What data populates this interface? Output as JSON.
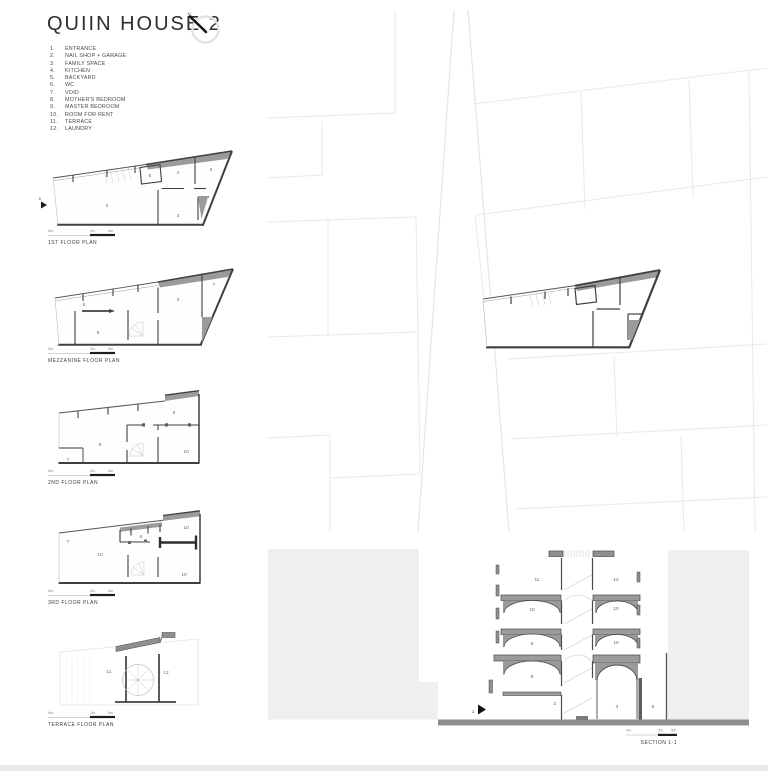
{
  "title": "QUIIN HOUSE 2",
  "north_label": "N.",
  "legend": [
    {
      "num": "1.",
      "label": "ENTRANCE"
    },
    {
      "num": "2.",
      "label": "NAIL SHOP + GARAGE"
    },
    {
      "num": "3.",
      "label": "FAMILY SPACE"
    },
    {
      "num": "4.",
      "label": "KITCHEN"
    },
    {
      "num": "5.",
      "label": "BACKYARD"
    },
    {
      "num": "6.",
      "label": "WC"
    },
    {
      "num": "7.",
      "label": "VOID"
    },
    {
      "num": "8.",
      "label": "MOTHER'S BEDROOM"
    },
    {
      "num": "9.",
      "label": "MASTER BEDROOM"
    },
    {
      "num": "10.",
      "label": "ROOM FOR RENT"
    },
    {
      "num": "11.",
      "label": "TERRACE"
    },
    {
      "num": "12.",
      "label": "LAUNDRY"
    }
  ],
  "scale": {
    "zero": "0m",
    "mid": "2m",
    "end": "5m"
  },
  "plans": [
    {
      "label": "1ST FLOOR PLAN",
      "marker": "1",
      "rooms": [
        "2",
        "6",
        "4",
        "5",
        "3"
      ]
    },
    {
      "label": "MEZZANINE FLOOR PLAN",
      "rooms": [
        "6",
        "8",
        "3",
        "7"
      ]
    },
    {
      "label": "2ND FLOOR PLAN",
      "rooms": [
        "7",
        "9",
        "6",
        "10"
      ]
    },
    {
      "label": "3RD FLOOR PLAN",
      "rooms": [
        "7",
        "10",
        "6",
        "10",
        "10"
      ]
    },
    {
      "label": "TERRACE FLOOR PLAN",
      "rooms": [
        "11",
        "12"
      ]
    }
  ],
  "section": {
    "label": "SECTION 1-1",
    "marker": "1",
    "rooms": [
      "11",
      "12",
      "10",
      "10",
      "9",
      "10",
      "8",
      "2",
      "3",
      "5"
    ]
  },
  "colors": {
    "wall": "#3f3f3f",
    "poche": "#9b9b9b",
    "mass": "#f0efed",
    "ground": "#8f8f8f",
    "parcel": "#e9e9e9",
    "text": "#3a3a3a"
  }
}
